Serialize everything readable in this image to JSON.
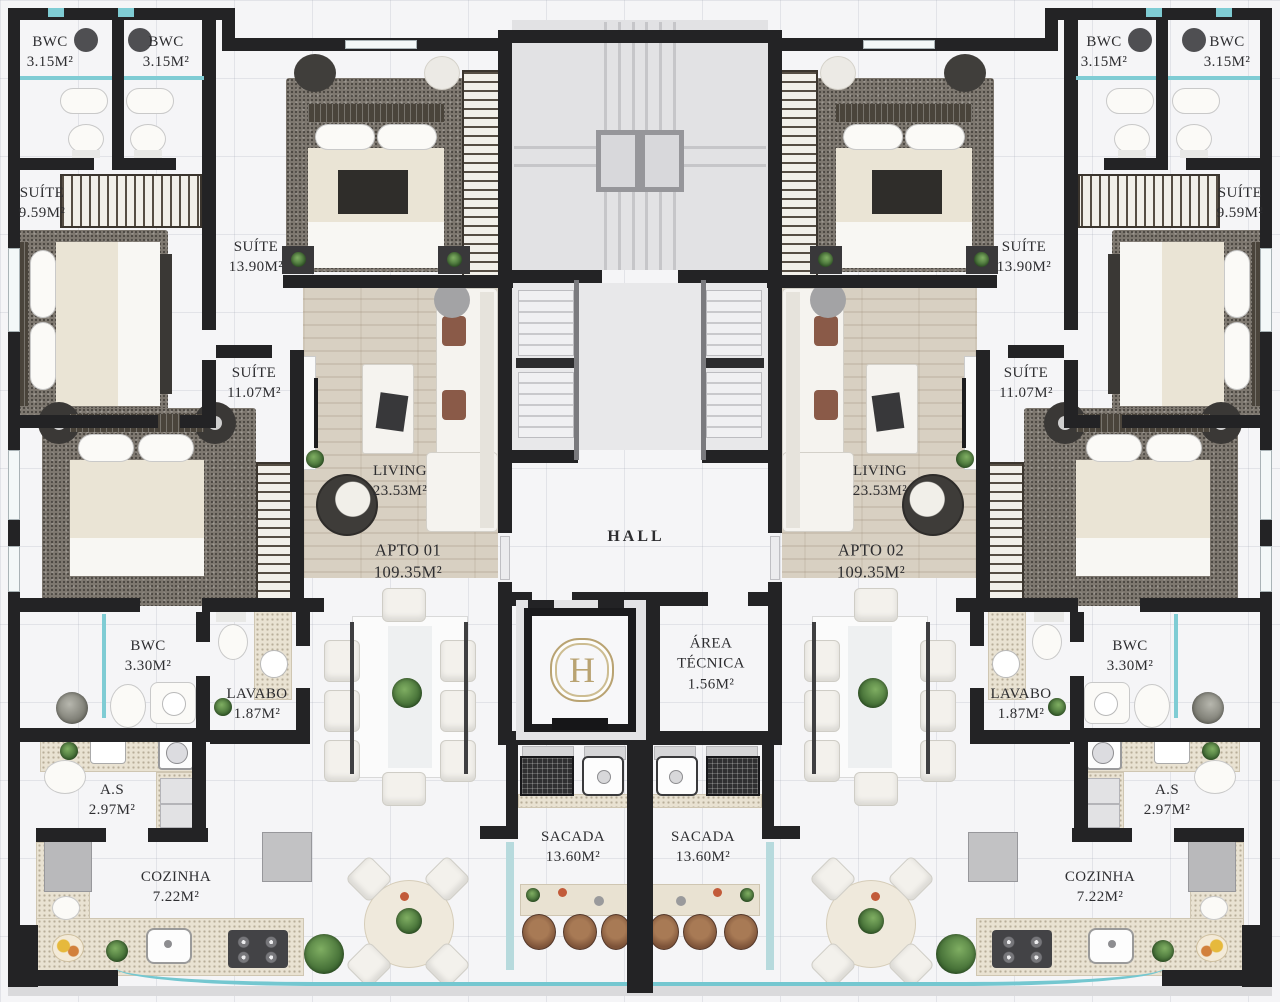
{
  "floorplan": {
    "hall": {
      "label": "HALL"
    },
    "elevator": {
      "monogram": "H"
    },
    "area_tecnica": {
      "line1": "ÁREA",
      "line2": "TÉCNICA",
      "area": "1.56M²"
    },
    "apartments": [
      {
        "name": "APTO 01",
        "area": "109.35M²"
      },
      {
        "name": "APTO 02",
        "area": "109.35M²"
      }
    ],
    "rooms_left": [
      {
        "name": "BWC",
        "area": "3.15M²"
      },
      {
        "name": "BWC",
        "area": "3.15M²"
      },
      {
        "name": "SUÍTE",
        "area": "9.59M²"
      },
      {
        "name": "SUÍTE",
        "area": "13.90M²"
      },
      {
        "name": "SUÍTE",
        "area": "11.07M²"
      },
      {
        "name": "LIVING",
        "area": "23.53M²"
      },
      {
        "name": "BWC",
        "area": "3.30M²"
      },
      {
        "name": "LAVABO",
        "area": "1.87M²"
      },
      {
        "name": "A.S",
        "area": "2.97M²"
      },
      {
        "name": "COZINHA",
        "area": "7.22M²"
      },
      {
        "name": "SACADA",
        "area": "13.60M²"
      }
    ],
    "rooms_right": [
      {
        "name": "BWC",
        "area": "3.15M²"
      },
      {
        "name": "BWC",
        "area": "3.15M²"
      },
      {
        "name": "SUÍTE",
        "area": "9.59M²"
      },
      {
        "name": "SUÍTE",
        "area": "13.90M²"
      },
      {
        "name": "SUÍTE",
        "area": "11.07M²"
      },
      {
        "name": "LIVING",
        "area": "23.53M²"
      },
      {
        "name": "BWC",
        "area": "3.30M²"
      },
      {
        "name": "LAVABO",
        "area": "1.87M²"
      },
      {
        "name": "A.S",
        "area": "2.97M²"
      },
      {
        "name": "COZINHA",
        "area": "7.22M²"
      },
      {
        "name": "SACADA",
        "area": "13.60M²"
      }
    ],
    "colors": {
      "wall": "#232325",
      "window_glass": "#7fccd4",
      "monogram_gold": "#b9a372"
    }
  }
}
